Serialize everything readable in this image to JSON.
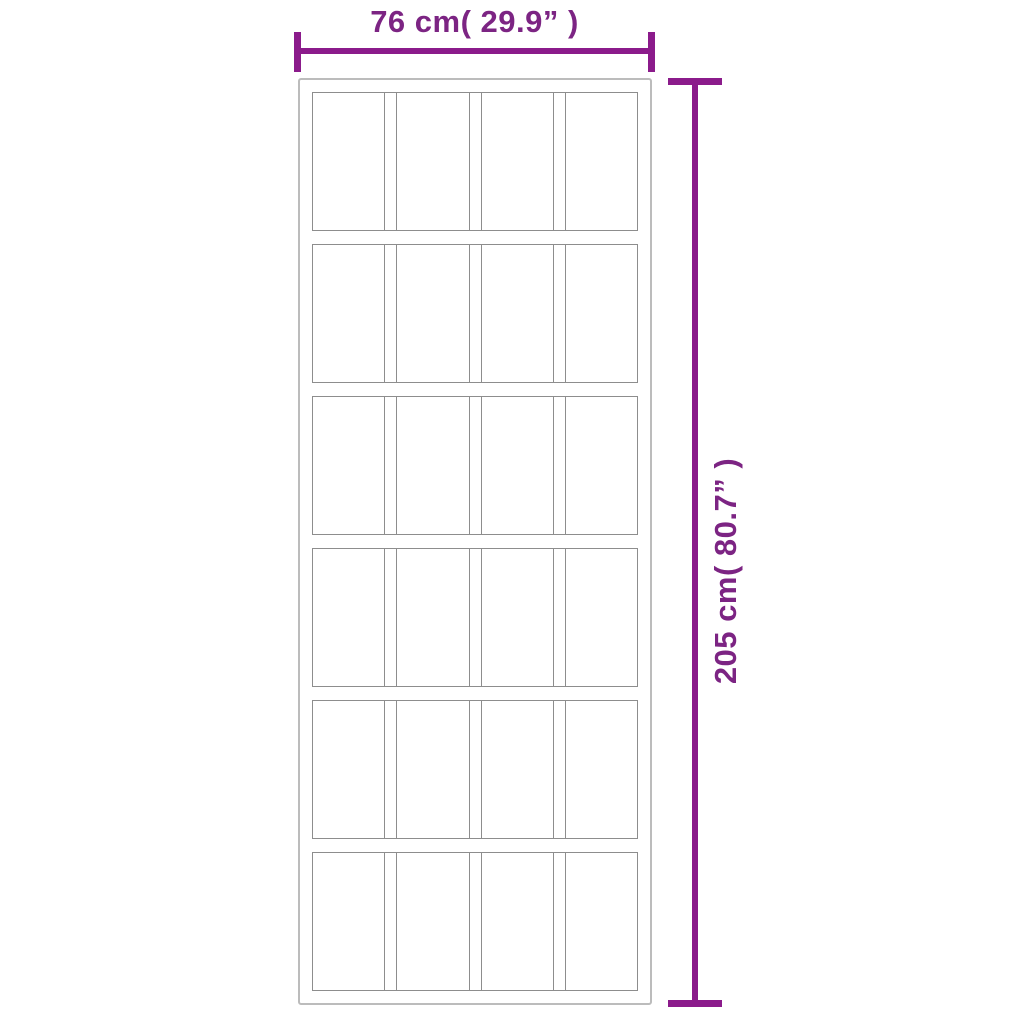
{
  "diagram": {
    "type": "product-dimension-diagram",
    "subject": "sliding door with grid of glass panels",
    "door": {
      "grid_rows": 6,
      "grid_columns": 4
    },
    "dimensions": {
      "width": {
        "label": "76 cm( 29.9” )",
        "value_cm": 76,
        "value_inch": 29.9
      },
      "height": {
        "label": "205 cm( 80.7” )",
        "value_cm": 205,
        "value_inch": 80.7
      }
    },
    "colors": {
      "dimension_line": "#8b1b8b",
      "dimension_text": "#7c2483",
      "door_frame": "#bcbcbc",
      "panel_line": "#8d8d8d",
      "background": "#ffffff"
    }
  }
}
